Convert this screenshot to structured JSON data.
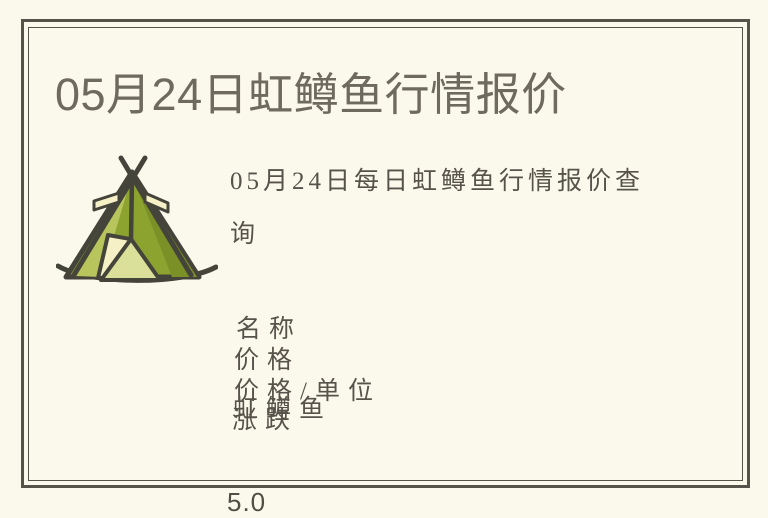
{
  "colors": {
    "page_background": "#FBF9EC",
    "frame_border": "#55534A",
    "title_text": "#6E6A5D",
    "body_text": "#57534B",
    "tent_outline": "#45443A",
    "tent_body": "#8CA32F",
    "tent_body_light": "#B8C55C",
    "tent_body_dark": "#7B9027",
    "tent_cream": "#F5F0C5",
    "tent_door": "#DADF9A"
  },
  "icons": [
    {
      "name": "tent-icon",
      "glyph": "⛺"
    }
  ],
  "article": {
    "title": "05月24日虹鳟鱼行情报价",
    "description": "05月24日每日虹鳟鱼行情报价查询"
  },
  "quote_table": {
    "lines": [
      "名称",
      "价格",
      "价格/单位",
      "虹鳟鱼",
      "涨跌"
    ],
    "price_value": "5.0"
  }
}
